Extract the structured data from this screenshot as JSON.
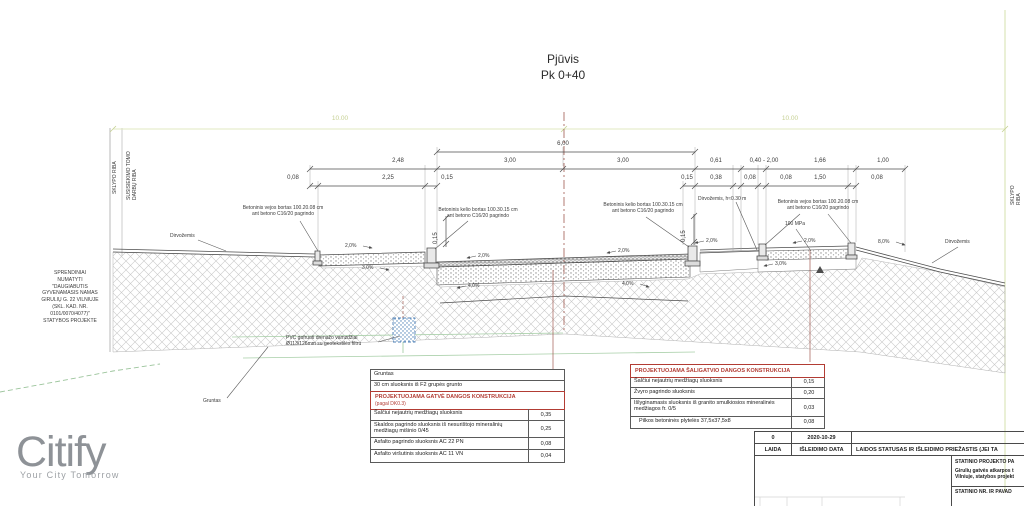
{
  "title": {
    "line1": "Pjūvis",
    "line2": "Pk 0+40"
  },
  "boundaries": {
    "left_outer": "SKLYPO RIBA",
    "left_inner": "SUSISIEKIMO TOMO\nDARBŲ RIBA",
    "right": "SKLYPO RIBA"
  },
  "dims": {
    "overall_left": "10.00",
    "overall_right": "10.00",
    "total": "6,00",
    "upper": [
      "2,48",
      "3,00",
      "3,00",
      "0,61",
      "0,40 - 2,00",
      "1,66",
      "1,00"
    ],
    "lower": [
      "0,08",
      "2,25",
      "0,15",
      "0,15",
      "0,38",
      "0,08",
      "0,08",
      "1,50",
      "0,08"
    ],
    "kerb_left": "0,15",
    "kerb_right": "0,15"
  },
  "slopes": [
    "2,0%",
    "3,0%",
    "2,0%",
    "2,0%",
    "2,0%",
    "2,0%",
    "8,0%",
    "3,0%",
    "4,0%",
    "4,0%"
  ],
  "labels": {
    "vejos_bortas": "Betoninis vejos bortas 100.20.08 cm\nant betono C16/20 pagrindo",
    "kelio_bortas": "Betoninis kelio bortas 100.30.15 cm\nant betono C16/20 pagrindo",
    "dirvozemis": "Dirvožemis",
    "dirvozemis_h": "Dirvožemis, h≈0.30 m",
    "mpa": "100 MPa",
    "gruntas": "Gruntas",
    "pvc": "PVC gofruoti drenažo vamzdžiai\nØ113/126mm su geotekstilės filtru",
    "note": "SPRENDINIAI\nNUMATYTI\n\"DAUGIABUTIS\nGYVENAMASIS NAMAS\nGIRULIŲ G. 22 VILNIUJE\n(SKL. KAD. NR.\n0101/0070/4077)\"\nSTATYBOS PROJEKTE"
  },
  "street_table": {
    "row1": "Gruntas",
    "row2": "30 cm sluoksnis iš F2 grupės grunto",
    "header": "PROJEKTUOJAMA GATVĖ DANGOS KONSTRUKCIJA",
    "header_sub": "(pagal DK0.3)",
    "rows": [
      {
        "label": "Šalčiui nejautrių medžiagų sluoksnis",
        "value": "0,35"
      },
      {
        "label": "Skaldos pagrindo sluoksnis iš nesurištojo mineralinių medžiagų mišinio 0/45",
        "value": "0,25"
      },
      {
        "label": "Asfalto pagrindo sluoksnis AC 22 PN",
        "value": "0,08"
      },
      {
        "label": "Asfalto viršutinis sluoksnis AC 11 VN",
        "value": "0,04"
      }
    ]
  },
  "sidewalk_table": {
    "header": "PROJEKTUOJAMA ŠALIGATVIO DANGOS KONSTRUKCIJA",
    "rows": [
      {
        "label": "Šalčiui nejautrių medžiagų sluoksnis",
        "value": "0,15"
      },
      {
        "label": "Žvyro pagrindo sluoksnis",
        "value": "0,20"
      },
      {
        "label": "Išlyginamasis sluoksnis iš granito smulkiosios mineralinės medžiagos fr. 0/5",
        "value": "0,03"
      },
      {
        "label": "Pilkos betoninės plytelės 37,5x37,5x8",
        "value": "0,08"
      }
    ]
  },
  "title_block": {
    "rev": "0",
    "date": "2020-10-29",
    "laida": "LAIDA",
    "date_label": "IŠLEIDIMO DATA",
    "status_label": "LAIDOS STATUSAS IR IŠLEIDIMO PRIEŽASTIS (JEI TA",
    "project_stage": "STATINIO PROJEKTO PA",
    "project_name_1": "Girulių gatvės atkarpos t",
    "project_name_2": "Vilniuje, statybos projekt",
    "statinio_label": "STATINIO NR. IR PAVAD"
  },
  "logo": {
    "name": "Citify",
    "tagline": "Your City Tomorrow"
  }
}
